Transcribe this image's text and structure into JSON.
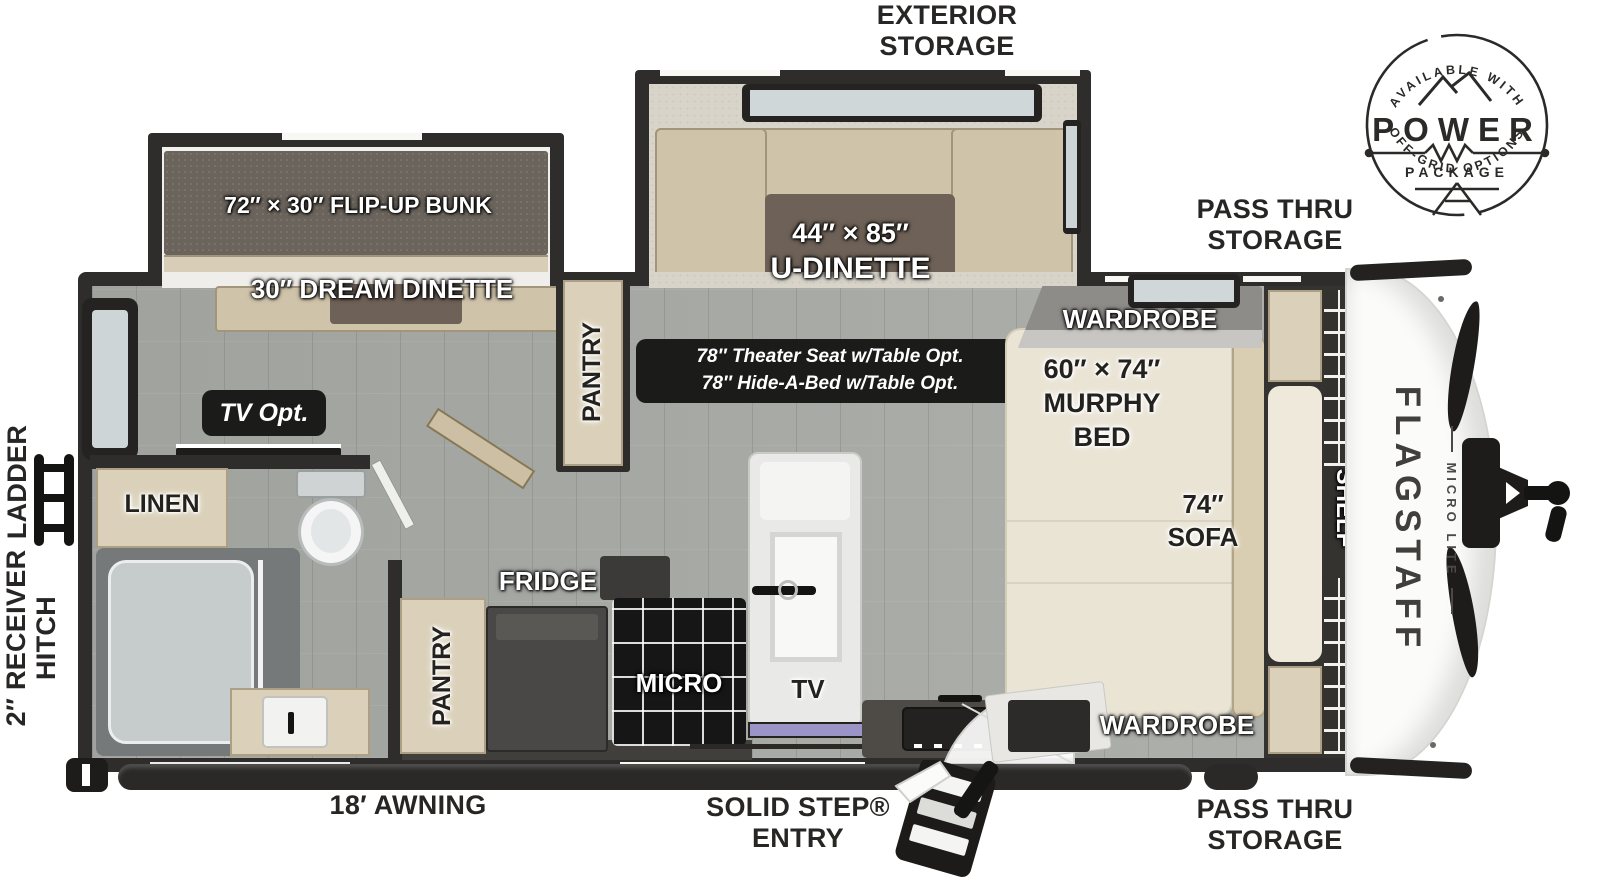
{
  "badge": {
    "available_with": "AVAILABLE WITH",
    "power": "POWER",
    "package": "PACKAGE",
    "off_grid_options": "OFF-GRID OPTIONS"
  },
  "exterior_labels": {
    "exterior_storage": "EXTERIOR STORAGE",
    "pass_thru_storage_top": "PASS THRU STORAGE",
    "pass_thru_storage_bottom": "PASS THRU STORAGE",
    "ladder": "LADDER",
    "receiver_hitch": "2″ RECEIVER HITCH",
    "awning": "18′ AWNING",
    "solid_step_entry": "SOLID STEP® ENTRY"
  },
  "slide_outs": {
    "flip_up_bunk": "72″ × 30″ FLIP-UP BUNK",
    "dream_dinette": "30″ DREAM DINETTE",
    "u_dinette_size": "44″ × 85″",
    "u_dinette_name": "U-DINETTE"
  },
  "living_area": {
    "theater_seat_option": "78″ Theater Seat w/Table Opt.",
    "hide_a_bed_option": "78″ Hide-A-Bed w/Table Opt.",
    "tv_option": "TV Opt.",
    "pantry": "PANTRY"
  },
  "bathroom": {
    "linen": "LINEN"
  },
  "kitchen": {
    "pantry": "PANTRY",
    "fridge": "FRIDGE",
    "micro": "MICRO",
    "tv": "TV"
  },
  "bedroom": {
    "wardrobe_top": "WARDROBE",
    "murphy_bed_size": "60″ × 74″",
    "murphy_bed_name": "MURPHY BED",
    "sofa": "74″ SOFA",
    "wardrobe_bottom": "WARDROBE",
    "shelf": "SHELF"
  },
  "front_cap": {
    "brand": "FLAGSTAFF",
    "model": "MICRO LITE"
  },
  "colors": {
    "wall": "#2e2d2b",
    "floor_gray": "#a8aba6",
    "cabinet_tan": "#dbd1ba",
    "label_badge_black": "#1b1b1a",
    "bed_cream": "#eae4d5",
    "table_brown": "#6e6157",
    "bunk_mattress": "#6b645c",
    "tv_screen": "#9a95c6"
  }
}
